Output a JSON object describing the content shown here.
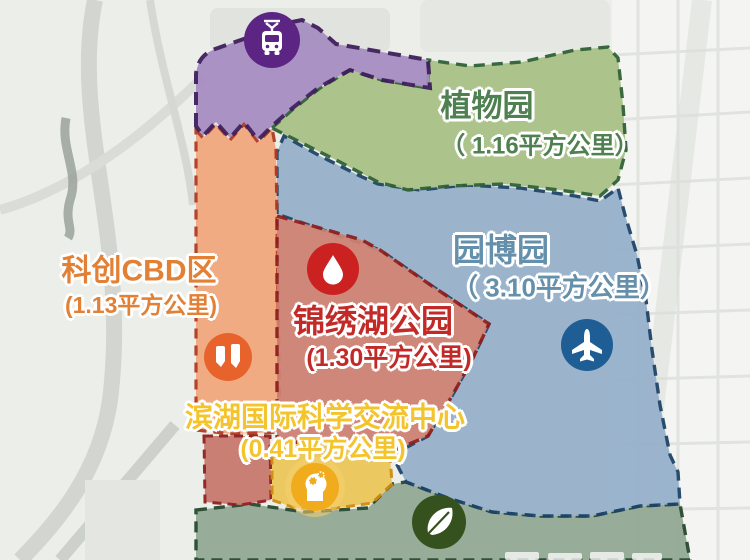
{
  "map": {
    "regions": [
      {
        "id": "botanical-garden",
        "name": "植物园",
        "area_label": "（ 1.16平方公里）",
        "fill": "#a9c287",
        "border": "#2f6136",
        "label_color": "#4e8050"
      },
      {
        "id": "garden-expo-park",
        "name": "园博园",
        "area_label": "（ 3.10平方公里）",
        "fill": "#97b1cb",
        "border": "#1e4468",
        "label_color": "#6590ab"
      },
      {
        "id": "sci-tech-cbd",
        "name": "科创CBD区",
        "area_label": "(1.13平方公里)",
        "fill": "#f2a87e",
        "border": "#b03a20",
        "label_color": "#e28035"
      },
      {
        "id": "jinxiu-lake-park",
        "name": "锦绣湖公园",
        "area_label": "(1.30平方公里)",
        "fill": "#cd8274",
        "border": "#8f1f1f",
        "label_color": "#c22a28"
      },
      {
        "id": "science-exchange-center",
        "name": "滨湖国际科学交流中心",
        "area_label": "(0.41平方公里)",
        "fill": "#edc75a",
        "border": "#d08a10",
        "label_color": "#f4c42c"
      },
      {
        "id": "transit-hub",
        "fill": "#a78fc2",
        "border": "#3f1f5c"
      },
      {
        "id": "south-green-belt",
        "fill": "#93a995",
        "border": "#26492e"
      },
      {
        "id": "lake-park-south-piece",
        "fill": "#c97a6e",
        "border": "#8f1f1f"
      }
    ],
    "icons": [
      {
        "name": "tram-icon",
        "bg": "#5c2483"
      },
      {
        "name": "water-drop-icon",
        "bg": "#cb2121"
      },
      {
        "name": "buildings-icon",
        "bg": "#e8632c"
      },
      {
        "name": "airplane-icon",
        "bg": "#1f5e94"
      },
      {
        "name": "innovation-head-icon",
        "bg": "#f0ac1c"
      },
      {
        "name": "leaf-icon",
        "bg": "#35511e"
      }
    ]
  }
}
